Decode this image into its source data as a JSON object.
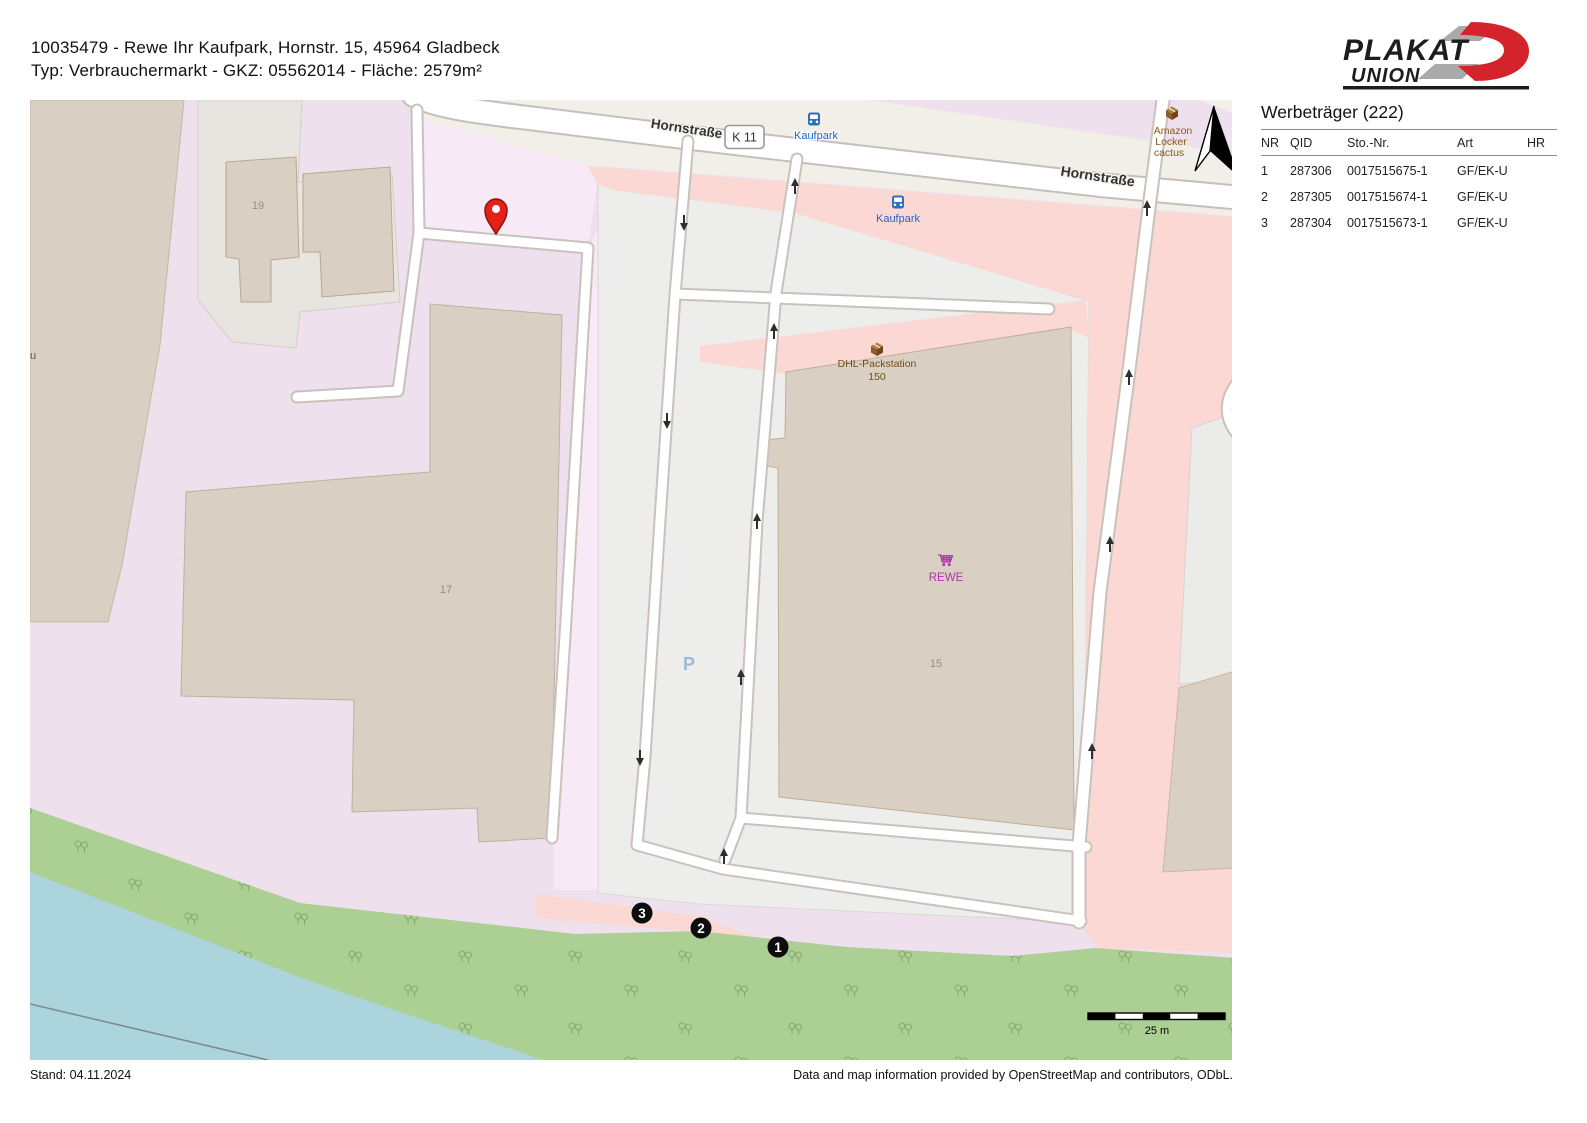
{
  "header": {
    "line1": "10035479 - Rewe Ihr Kaufpark, Hornstr. 15, 45964 Gladbeck",
    "line2": "Typ: Verbrauchermarkt - GKZ: 05562014 - Fläche: 2579m²"
  },
  "logo": {
    "plakat": "PLAKAT",
    "union": "UNION"
  },
  "panel": {
    "title": "Werbeträger (222)",
    "columns": [
      "NR",
      "QID",
      "Sto.-Nr.",
      "Art",
      "HR"
    ],
    "rows": [
      [
        "1",
        "287306",
        "0017515675-1",
        "GF/EK-U",
        ""
      ],
      [
        "2",
        "287305",
        "0017515674-1",
        "GF/EK-U",
        ""
      ],
      [
        "3",
        "287304",
        "0017515673-1",
        "GF/EK-U",
        ""
      ]
    ]
  },
  "map": {
    "street1": "Hornstraße",
    "street2": "Hornstraße",
    "ref": "K 11",
    "bus1": "Kaufpark",
    "bus2": "Kaufpark",
    "amazon": [
      "Amazon",
      "Locker",
      "cactus"
    ],
    "dhl": [
      "DHL-Packstation",
      "150"
    ],
    "rewe": "REWE",
    "parking": "P",
    "housenumbers": [
      "19",
      "17",
      "15"
    ],
    "edge_text": "u",
    "markers": [
      "1",
      "2",
      "3"
    ],
    "scale": "25 m"
  },
  "footer": {
    "left": "Stand: 04.11.2024",
    "right": "Data and map information provided by OpenStreetMap and contributors, ODbL."
  },
  "colors": {
    "brand_red": "#d5232b",
    "logo_dark": "#1d1d1b",
    "retail_lavender": "#eee0ed",
    "parcel_pink": "#f7eaf6",
    "building_tan": "#dacfc3",
    "area_gray": "#e8e5e1",
    "parking_gray": "#ededec",
    "road_cream": "#f2efe8",
    "pedestrian_salmon": "#fbd8d3",
    "green": "#accf94",
    "water": "#abd4dd",
    "bus_blue": "#2a70bf",
    "label_blue": "#1f62c5",
    "poi_brown": "#7c5514",
    "rewe_magenta": "#ab37a7",
    "pin_red": "#e32119"
  }
}
